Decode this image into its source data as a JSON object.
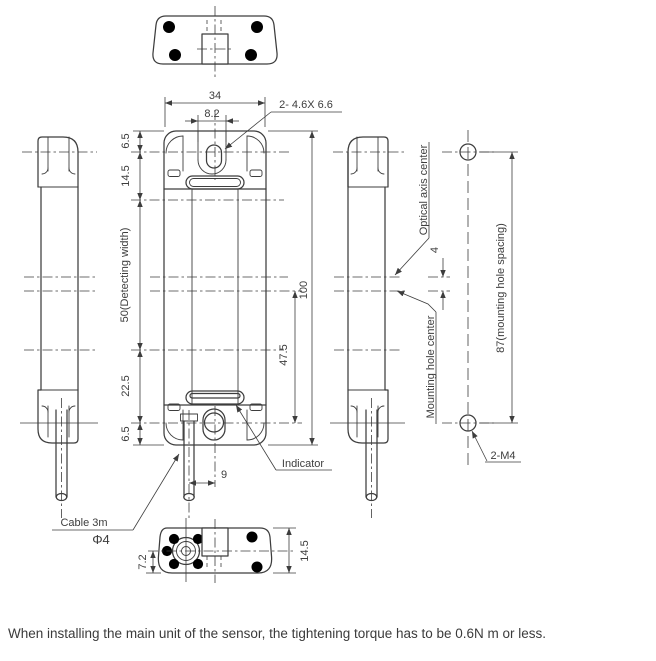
{
  "caption": "When installing the main unit of the sensor, the tightening torque has to be 0.6N m or less.",
  "colors": {
    "line": "#3d3d3d",
    "indicator": "#b2b2b2",
    "indicator_dark": "#808080"
  },
  "dims": {
    "width": "34",
    "slot_pitch": "8.2",
    "top_margin": "6.5",
    "cap_height": "14.5",
    "detecting_width": "50(Detecting width)",
    "lower_span": "22.5",
    "bottom_margin": "6.5",
    "height": "100",
    "axis_to_hole": "47.5",
    "cable_offset": "9",
    "axis_gap": "4",
    "hole_spacing": "87(mounting hole spacing)",
    "bottom_depth": "7.2",
    "bottom_height": "14.5"
  },
  "callouts": {
    "slot_spec": "2- 4.6X 6.6",
    "indicator": "Indicator",
    "cable": "Cable 3m",
    "cable_diameter": "Φ4",
    "optical_axis": "Optical axis center",
    "mounting_hole_center": "Mounting hole center",
    "hole_spec": "2-M4"
  }
}
